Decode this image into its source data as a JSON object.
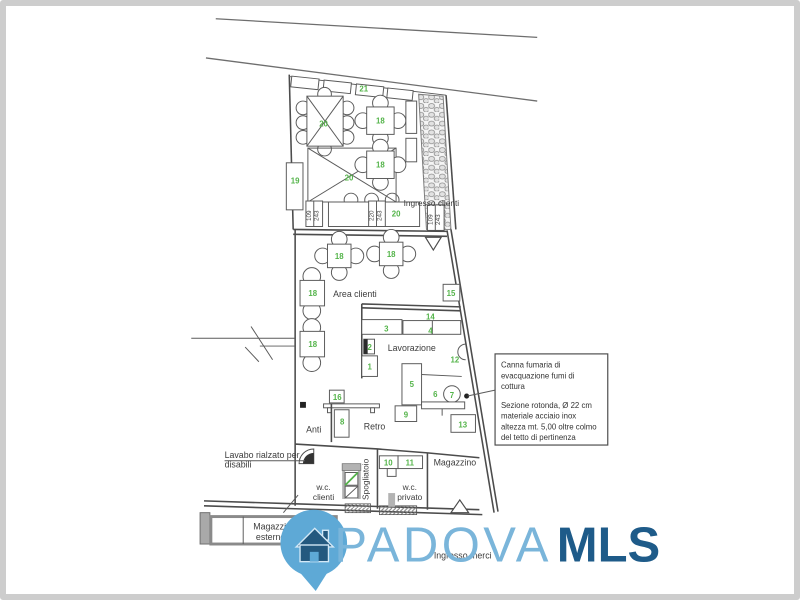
{
  "colors": {
    "plan_line": "#4c4c4c",
    "green": "#54b44a",
    "border_gray": "#cdcdcd",
    "logo_light_blue": "#74b3da",
    "logo_dark_blue": "#1e5b89"
  },
  "labels": {
    "ingresso_clienti": "Ingresso clienti",
    "area_clienti": "Area clienti",
    "lavorazione": "Lavorazione",
    "anti": "Anti",
    "retro": "Retro",
    "magazzino": "Magazzino",
    "wc": "w.c.",
    "clienti": "clienti",
    "privato": "privato",
    "spogliatoio": "Spogliatoio",
    "magazzino_esterno_1": "Magazzino",
    "magazzino_esterno_2": "esterno",
    "lavabo_1": "Lavabo rialzato per",
    "lavabo_2": "disabili",
    "ingresso_merci": "Ingresso merci"
  },
  "green_labels": [
    "21",
    "20",
    "18",
    "18",
    "20",
    "19",
    "20",
    "18",
    "18",
    "18",
    "18",
    "15",
    "3",
    "14",
    "4",
    "2",
    "12",
    "1",
    "5",
    "6",
    "7",
    "16",
    "8",
    "9",
    "13",
    "10",
    "11"
  ],
  "dimensions": [
    "109",
    "243",
    "220",
    "243",
    "109",
    "243"
  ],
  "note_box": {
    "lines": [
      "Canna fumaria di",
      "evacquazione fumi di",
      "cottura",
      "Sezione rotonda, Ø 22 cm",
      "materiale acciaio inox",
      "altezza mt. 5,00 oltre colmo",
      "del tetto di pertinenza"
    ]
  },
  "logo": {
    "padova": "PADOVA",
    "mls": "MLS"
  }
}
